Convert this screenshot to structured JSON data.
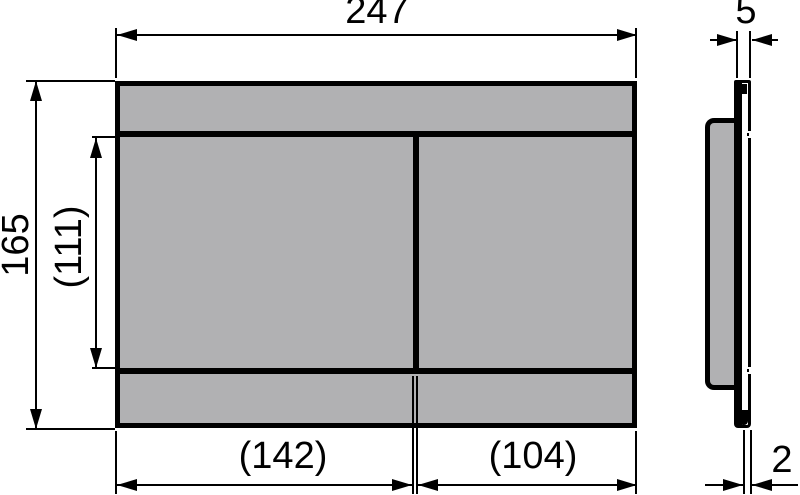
{
  "colors": {
    "background": "#ffffff",
    "panel_fill": "#b1b1b3",
    "line": "#000000"
  },
  "dimensions": {
    "overall_width": "247",
    "overall_height": "165",
    "button_area_height": "(111)",
    "left_button_width": "(142)",
    "right_button_width": "(104)",
    "depth": "5",
    "plate_thickness": "2"
  }
}
